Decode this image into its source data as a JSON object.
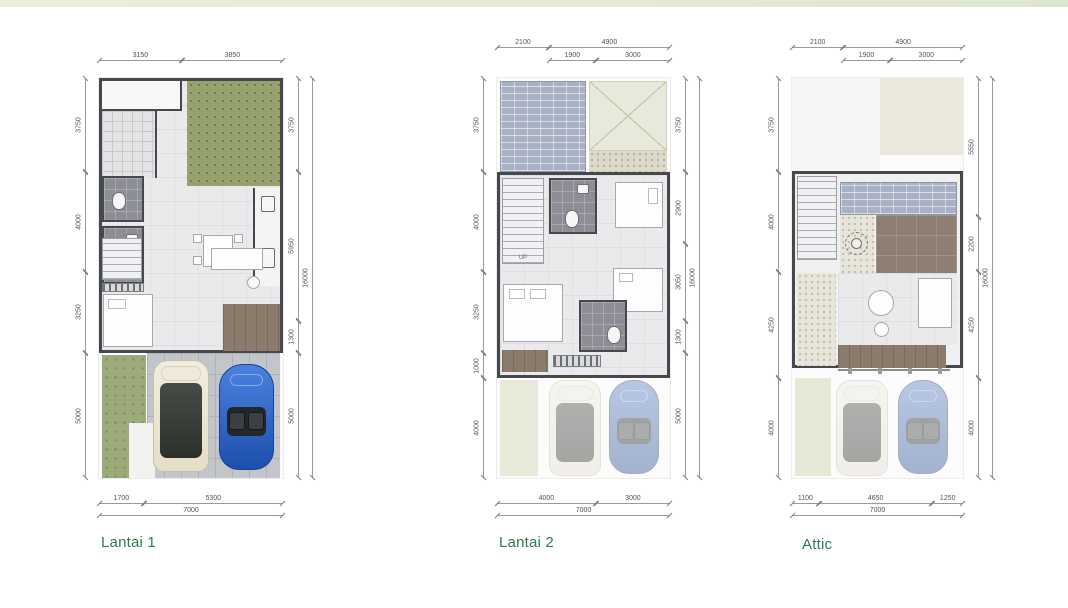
{
  "page": {
    "background": "#ffffff",
    "top_band": {
      "left_color": "#efeeda",
      "right_color": "#dde6d3"
    }
  },
  "colors": {
    "title_green": "#2f7b50",
    "wall": "#45494e",
    "garden_olive": "#98a26f",
    "roof_tile_blue_gray": "#a9b2c5",
    "deck_brown": "#8b7b6c",
    "bathroom_gray": "#8d8d95",
    "car_blue": "#2e69cf",
    "car_cream": "#efe8d8"
  },
  "plans": [
    {
      "title": "Lantai 1",
      "width_mm": 7000,
      "height_mm": 16000,
      "top_rows": [
        {
          "offset_mm": 0,
          "segments": [
            {
              "label": "3150",
              "mm": 3150
            },
            {
              "label": "3850",
              "mm": 3850
            }
          ]
        }
      ],
      "left_col": {
        "segments": [
          {
            "label": "3750",
            "mm": 3750
          },
          {
            "label": "4000",
            "mm": 4000
          },
          {
            "label": "3250",
            "mm": 3250
          },
          {
            "label": "5000",
            "mm": 5000
          }
        ]
      },
      "right_cols": [
        {
          "segments": [
            {
              "label": "3750",
              "mm": 3750
            },
            {
              "label": "5950",
              "mm": 5950
            },
            {
              "label": "1300",
              "mm": 1300
            },
            {
              "label": "5000",
              "mm": 5000
            }
          ]
        },
        {
          "segments": [
            {
              "label": "16000",
              "mm": 16000
            }
          ]
        }
      ],
      "bottom_rows": [
        {
          "offset_mm": 0,
          "segments": [
            {
              "label": "1700",
              "mm": 1700
            },
            {
              "label": "5300",
              "mm": 5300
            }
          ]
        },
        {
          "offset_mm": 0,
          "segments": [
            {
              "label": "7000",
              "mm": 7000
            }
          ]
        }
      ]
    },
    {
      "title": "Lantai 2",
      "width_mm": 7000,
      "height_mm": 16000,
      "labels": {
        "stairs": "UP"
      },
      "top_rows": [
        {
          "offset_mm": 0,
          "segments": [
            {
              "label": "2100",
              "mm": 2100
            },
            {
              "label": "4900",
              "mm": 4900
            }
          ]
        },
        {
          "offset_mm": 2100,
          "segments": [
            {
              "label": "1900",
              "mm": 1900
            },
            {
              "label": "3000",
              "mm": 3000
            }
          ]
        }
      ],
      "left_col": {
        "segments": [
          {
            "label": "3750",
            "mm": 3750
          },
          {
            "label": "4000",
            "mm": 4000
          },
          {
            "label": "3250",
            "mm": 3250
          },
          {
            "label": "1000",
            "mm": 1000
          },
          {
            "label": "4000",
            "mm": 4000
          }
        ]
      },
      "right_cols": [
        {
          "segments": [
            {
              "label": "3750",
              "mm": 3750
            },
            {
              "label": "2900",
              "mm": 2900
            },
            {
              "label": "3050",
              "mm": 3050
            },
            {
              "label": "1300",
              "mm": 1300
            },
            {
              "label": "5000",
              "mm": 5000
            }
          ]
        },
        {
          "segments": [
            {
              "label": "16000",
              "mm": 16000
            }
          ]
        }
      ],
      "bottom_rows": [
        {
          "offset_mm": 0,
          "segments": [
            {
              "label": "4000",
              "mm": 4000
            },
            {
              "label": "3000",
              "mm": 3000
            }
          ]
        },
        {
          "offset_mm": 0,
          "segments": [
            {
              "label": "7000",
              "mm": 7000
            }
          ]
        }
      ]
    },
    {
      "title": "Attic",
      "width_mm": 7000,
      "height_mm": 16000,
      "top_rows": [
        {
          "offset_mm": 0,
          "segments": [
            {
              "label": "2100",
              "mm": 2100
            },
            {
              "label": "4900",
              "mm": 4900
            }
          ]
        },
        {
          "offset_mm": 2100,
          "segments": [
            {
              "label": "1900",
              "mm": 1900
            },
            {
              "label": "3000",
              "mm": 3000
            }
          ]
        }
      ],
      "left_col": {
        "segments": [
          {
            "label": "3750",
            "mm": 3750
          },
          {
            "label": "4000",
            "mm": 4000
          },
          {
            "label": "4250",
            "mm": 4250
          },
          {
            "label": "4000",
            "mm": 4000
          }
        ]
      },
      "right_cols": [
        {
          "segments": [
            {
              "label": "5550",
              "mm": 5550
            },
            {
              "label": "2200",
              "mm": 2200
            },
            {
              "label": "4250",
              "mm": 4250
            },
            {
              "label": "4000",
              "mm": 4000
            }
          ]
        },
        {
          "segments": [
            {
              "label": "16000",
              "mm": 16000
            }
          ]
        }
      ],
      "bottom_rows": [
        {
          "offset_mm": 0,
          "segments": [
            {
              "label": "1100",
              "mm": 1100
            },
            {
              "label": "4650",
              "mm": 4650
            },
            {
              "label": "1250",
              "mm": 1250
            }
          ]
        },
        {
          "offset_mm": 0,
          "segments": [
            {
              "label": "7000",
              "mm": 7000
            }
          ]
        }
      ]
    }
  ]
}
